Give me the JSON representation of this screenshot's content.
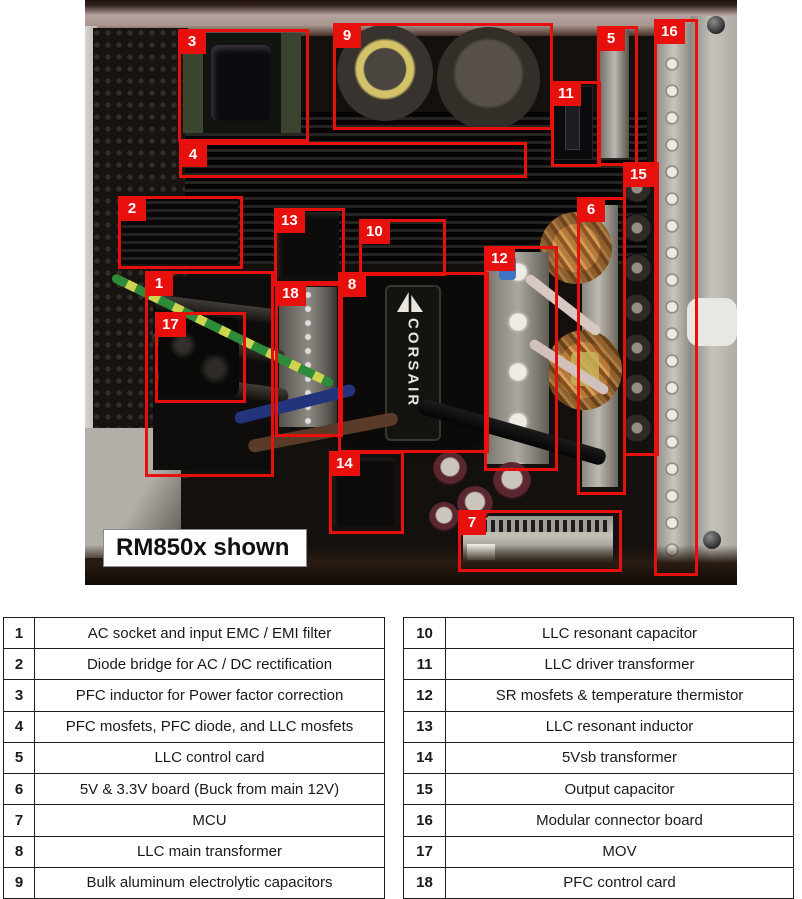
{
  "photo": {
    "caption": "RM850x shown",
    "transformer_brand": "CORSAIR",
    "accent_red": "#e8100c",
    "callouts": [
      {
        "num": "1",
        "x": 60,
        "y": 271,
        "w": 123,
        "h": 200
      },
      {
        "num": "2",
        "x": 33,
        "y": 196,
        "w": 119,
        "h": 67
      },
      {
        "num": "3",
        "x": 93,
        "y": 29,
        "w": 125,
        "h": 107
      },
      {
        "num": "4",
        "x": 94,
        "y": 142,
        "w": 342,
        "h": 30
      },
      {
        "num": "5",
        "x": 512,
        "y": 26,
        "w": 35,
        "h": 134
      },
      {
        "num": "6",
        "x": 492,
        "y": 197,
        "w": 43,
        "h": 292
      },
      {
        "num": "7",
        "x": 373,
        "y": 510,
        "w": 158,
        "h": 56
      },
      {
        "num": "8",
        "x": 253,
        "y": 272,
        "w": 145,
        "h": 175
      },
      {
        "num": "9",
        "x": 248,
        "y": 23,
        "w": 214,
        "h": 101
      },
      {
        "num": "10",
        "x": 274,
        "y": 219,
        "w": 81,
        "h": 51
      },
      {
        "num": "11",
        "x": 466,
        "y": 81,
        "w": 44,
        "h": 80
      },
      {
        "num": "12",
        "x": 399,
        "y": 246,
        "w": 68,
        "h": 219
      },
      {
        "num": "13",
        "x": 189,
        "y": 208,
        "w": 65,
        "h": 72
      },
      {
        "num": "14",
        "x": 244,
        "y": 451,
        "w": 69,
        "h": 77
      },
      {
        "num": "15",
        "x": 538,
        "y": 162,
        "w": 30,
        "h": 288
      },
      {
        "num": "16",
        "x": 569,
        "y": 19,
        "w": 38,
        "h": 551
      },
      {
        "num": "17",
        "x": 70,
        "y": 312,
        "w": 85,
        "h": 85
      },
      {
        "num": "18",
        "x": 190,
        "y": 281,
        "w": 62,
        "h": 150
      }
    ]
  },
  "legend": {
    "columns": [
      {
        "rows": [
          {
            "num": "1",
            "label": "AC socket and input EMC / EMI filter"
          },
          {
            "num": "2",
            "label": "Diode bridge for AC / DC rectification"
          },
          {
            "num": "3",
            "label": "PFC inductor for Power factor correction"
          },
          {
            "num": "4",
            "label": "PFC mosfets, PFC diode, and LLC mosfets"
          },
          {
            "num": "5",
            "label": "LLC control card"
          },
          {
            "num": "6",
            "label": "5V & 3.3V board (Buck from main 12V)"
          },
          {
            "num": "7",
            "label": "MCU"
          },
          {
            "num": "8",
            "label": "LLC main transformer"
          },
          {
            "num": "9",
            "label": "Bulk aluminum electrolytic capacitors"
          }
        ]
      },
      {
        "rows": [
          {
            "num": "10",
            "label": "LLC resonant capacitor"
          },
          {
            "num": "11",
            "label": "LLC driver transformer"
          },
          {
            "num": "12",
            "label": "SR mosfets & temperature thermistor"
          },
          {
            "num": "13",
            "label": "LLC resonant inductor"
          },
          {
            "num": "14",
            "label": "5Vsb transformer"
          },
          {
            "num": "15",
            "label": "Output capacitor"
          },
          {
            "num": "16",
            "label": "Modular connector board"
          },
          {
            "num": "17",
            "label": "MOV"
          },
          {
            "num": "18",
            "label": "PFC control card"
          }
        ]
      }
    ]
  }
}
